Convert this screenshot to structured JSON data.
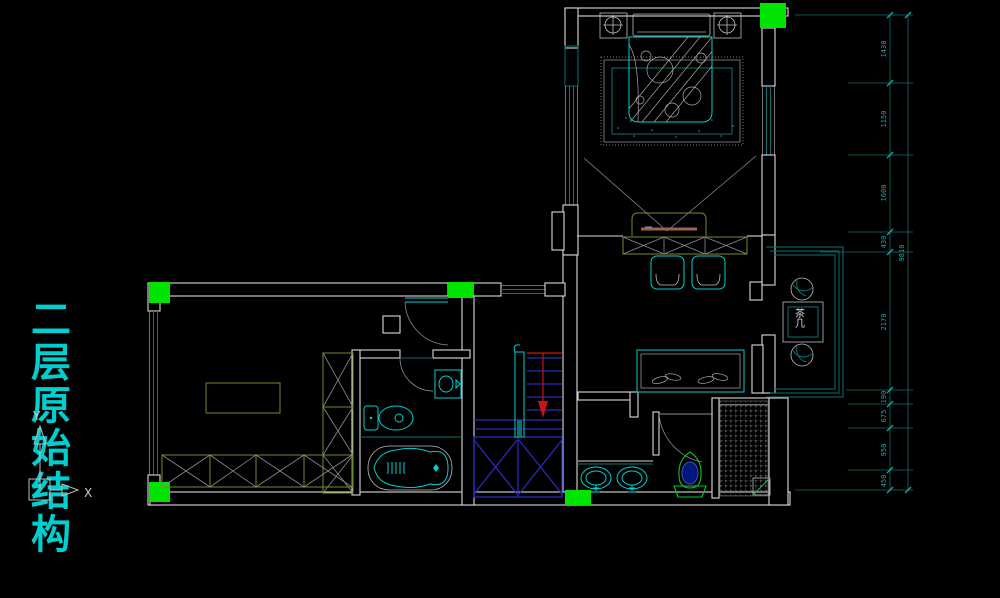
{
  "title": {
    "text": "二层原始结构"
  },
  "axis": {
    "x_label": "X",
    "y_label": "Y"
  },
  "labels": {
    "tea_table": "茶几"
  },
  "dimensions": {
    "total": "9810",
    "segments": [
      "1430",
      "1150",
      "1600",
      "430",
      "2170",
      "190",
      "675",
      "950",
      "450"
    ]
  },
  "colors": {
    "background": "#000000",
    "wall": "#D9D9D9",
    "cyan": "#00CFCF",
    "teal": "#0E7070",
    "dim_text": "#1FA8A8",
    "green": "#00E400",
    "olive": "#6E8F2E",
    "blue": "#2A2ABE",
    "navy": "#001878",
    "red": "#C81414",
    "gray": "#8C8C8C",
    "toilet_green": "#00C832",
    "tv_brown": "#9C6450"
  }
}
